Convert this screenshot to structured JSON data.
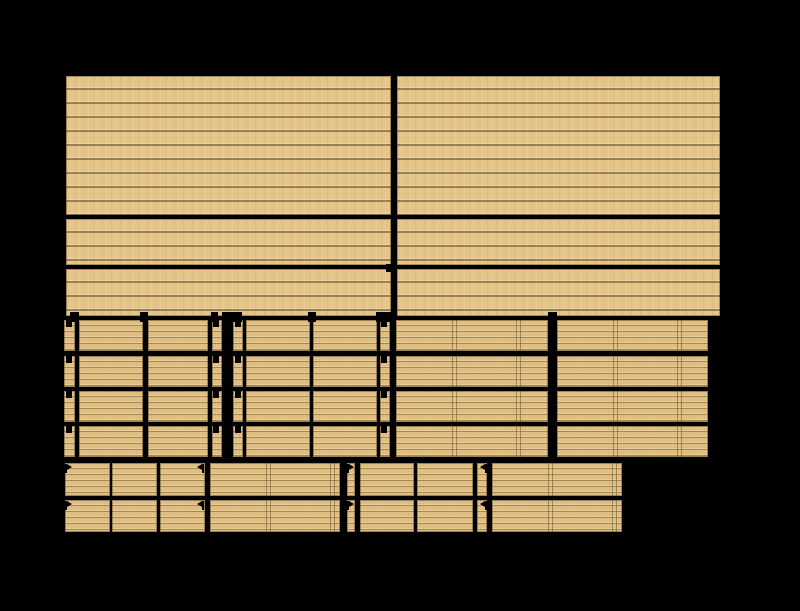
{
  "canvas": {
    "width": 800,
    "height": 611,
    "background": "#000000"
  },
  "palette": {
    "wood": "#e4c489",
    "wood_fine": "#e2c084",
    "plank_line": "#6e5a33",
    "plank_highlight": "#f6e4b4",
    "seam_line": "#6c562e",
    "cut": "#000000"
  },
  "panels": [
    {
      "name": "top-sheet-upper-left",
      "x": 66,
      "y": 76,
      "w": 325,
      "h": 139,
      "tex": "coarse"
    },
    {
      "name": "top-sheet-upper-right",
      "x": 397,
      "y": 76,
      "w": 323,
      "h": 139,
      "tex": "coarse"
    },
    {
      "name": "top-sheet-mid-left",
      "x": 66,
      "y": 219,
      "w": 325,
      "h": 46,
      "tex": "coarse"
    },
    {
      "name": "top-sheet-mid-right",
      "x": 397,
      "y": 219,
      "w": 323,
      "h": 46,
      "tex": "coarse"
    },
    {
      "name": "top-sheet-lower-left",
      "x": 66,
      "y": 269,
      "w": 325,
      "h": 47,
      "tex": "coarse"
    },
    {
      "name": "top-sheet-lower-right",
      "x": 397,
      "y": 269,
      "w": 323,
      "h": 47,
      "tex": "coarse"
    }
  ],
  "grids": [
    {
      "name": "middle-left-grid",
      "tex": "fine",
      "cols": [
        [
          64,
          11
        ],
        [
          79,
          64
        ],
        [
          148,
          60
        ],
        [
          212,
          10
        ],
        [
          233,
          10
        ],
        [
          246,
          64
        ],
        [
          313,
          64
        ],
        [
          380,
          10
        ]
      ],
      "rows": [
        [
          320,
          31
        ],
        [
          356,
          31
        ],
        [
          391,
          31
        ],
        [
          426,
          31
        ]
      ]
    },
    {
      "name": "middle-right-grid",
      "tex": "fine-seam",
      "cols": [
        [
          396,
          152
        ],
        [
          557,
          151
        ]
      ],
      "rows": [
        [
          320,
          31
        ],
        [
          356,
          31
        ],
        [
          391,
          31
        ],
        [
          426,
          31
        ]
      ]
    },
    {
      "name": "bottom-small-left-grid",
      "tex": "fine",
      "cols": [
        [
          65,
          45
        ],
        [
          112,
          45
        ],
        [
          160,
          45
        ]
      ],
      "rows": [
        [
          463,
          33
        ],
        [
          500,
          32
        ]
      ]
    },
    {
      "name": "bottom-wide-left-grid",
      "tex": "fine-seam",
      "cols": [
        [
          210,
          130
        ]
      ],
      "rows": [
        [
          463,
          33
        ],
        [
          500,
          32
        ]
      ]
    },
    {
      "name": "bottom-small-mid-grid",
      "tex": "fine",
      "cols": [
        [
          347,
          8
        ],
        [
          360,
          54
        ],
        [
          417,
          56
        ],
        [
          477,
          10
        ]
      ],
      "rows": [
        [
          463,
          33
        ],
        [
          500,
          32
        ]
      ]
    },
    {
      "name": "bottom-wide-right-grid",
      "tex": "fine-seam",
      "cols": [
        [
          492,
          130
        ]
      ],
      "rows": [
        [
          463,
          33
        ],
        [
          500,
          32
        ]
      ]
    }
  ],
  "marks": {
    "slot_squares": [
      {
        "x": 66,
        "y": 320,
        "w": 6,
        "h": 7
      },
      {
        "x": 213,
        "y": 320,
        "w": 6,
        "h": 7
      },
      {
        "x": 235,
        "y": 320,
        "w": 6,
        "h": 7
      },
      {
        "x": 381,
        "y": 320,
        "w": 6,
        "h": 7
      },
      {
        "x": 66,
        "y": 356,
        "w": 6,
        "h": 7
      },
      {
        "x": 213,
        "y": 356,
        "w": 6,
        "h": 7
      },
      {
        "x": 235,
        "y": 356,
        "w": 6,
        "h": 7
      },
      {
        "x": 381,
        "y": 356,
        "w": 6,
        "h": 7
      },
      {
        "x": 66,
        "y": 391,
        "w": 6,
        "h": 7
      },
      {
        "x": 213,
        "y": 391,
        "w": 6,
        "h": 7
      },
      {
        "x": 235,
        "y": 391,
        "w": 6,
        "h": 7
      },
      {
        "x": 381,
        "y": 391,
        "w": 6,
        "h": 7
      },
      {
        "x": 66,
        "y": 426,
        "w": 6,
        "h": 7
      },
      {
        "x": 213,
        "y": 426,
        "w": 6,
        "h": 7
      },
      {
        "x": 235,
        "y": 426,
        "w": 6,
        "h": 7
      },
      {
        "x": 381,
        "y": 426,
        "w": 6,
        "h": 7
      },
      {
        "x": 386,
        "y": 264,
        "w": 7,
        "h": 8
      }
    ],
    "notches": [
      {
        "x": 70,
        "y": 312,
        "w": 9,
        "h": 10
      },
      {
        "x": 140,
        "y": 312,
        "w": 8,
        "h": 10
      },
      {
        "x": 211,
        "y": 312,
        "w": 7,
        "h": 10
      },
      {
        "x": 222,
        "y": 312,
        "w": 20,
        "h": 10
      },
      {
        "x": 308,
        "y": 312,
        "w": 8,
        "h": 10
      },
      {
        "x": 376,
        "y": 312,
        "w": 17,
        "h": 10
      },
      {
        "x": 548,
        "y": 312,
        "w": 9,
        "h": 10
      }
    ],
    "arrows": [
      {
        "x": 65,
        "y": 464,
        "dir": "right"
      },
      {
        "x": 197,
        "y": 464,
        "dir": "left"
      },
      {
        "x": 347,
        "y": 464,
        "dir": "right"
      },
      {
        "x": 480,
        "y": 464,
        "dir": "left"
      },
      {
        "x": 65,
        "y": 501,
        "dir": "right"
      },
      {
        "x": 197,
        "y": 501,
        "dir": "left"
      },
      {
        "x": 347,
        "y": 501,
        "dir": "right"
      },
      {
        "x": 480,
        "y": 501,
        "dir": "left"
      }
    ]
  }
}
